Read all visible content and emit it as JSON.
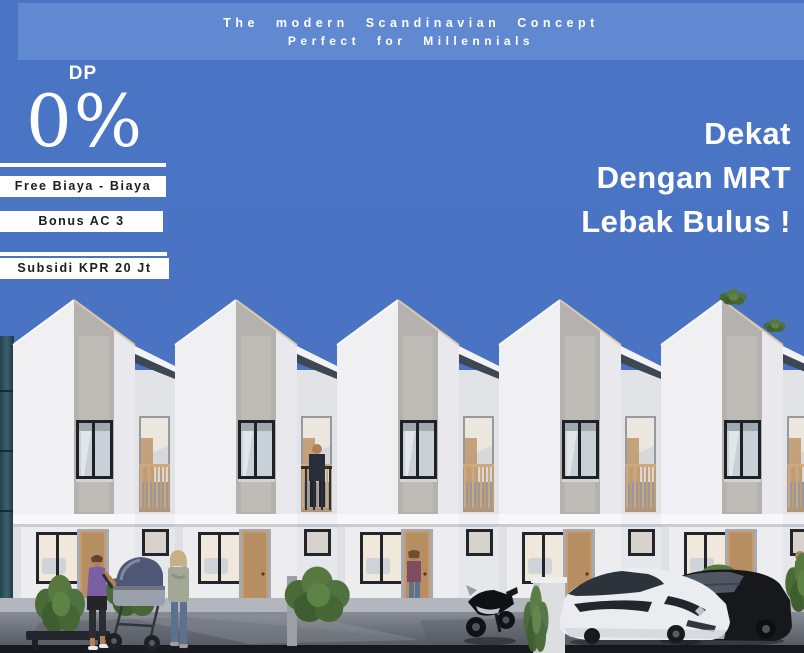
{
  "banner": {
    "line1": "The modern Scandinavian Concept",
    "line2": "Perfect for Millennials"
  },
  "promo": {
    "label": "DP",
    "value": "0%"
  },
  "badges": [
    {
      "label": "Free Biaya - Biaya"
    },
    {
      "label": "Bonus AC 3"
    },
    {
      "label": "Subsidi KPR 20 Jt"
    }
  ],
  "headline": {
    "line1": "Dekat",
    "line2": "Dengan MRT",
    "line3": "Lebak Bulus !"
  },
  "scene": {
    "subject": "row of five scandinavian gable townhouses",
    "objects": [
      "motorcycle",
      "white-hatchback-car",
      "black-car",
      "baby-stroller",
      "woman-with-stroller",
      "standing-woman",
      "man-on-balcony",
      "woman-in-doorway",
      "hedges",
      "bench",
      "planter-box"
    ]
  },
  "colors": {
    "background": "#4a74c5",
    "band": "#6189d1",
    "badge_bg": "#ffffff",
    "badge_text": "#1c1c1c",
    "text_light": "#ffffff",
    "facade": "#f0f0f3",
    "roof_stripe": "#b5b1ae",
    "door_wood": "#c29b70",
    "hedge_green": "#57793f",
    "pavement_dark": "#4a4e57"
  }
}
